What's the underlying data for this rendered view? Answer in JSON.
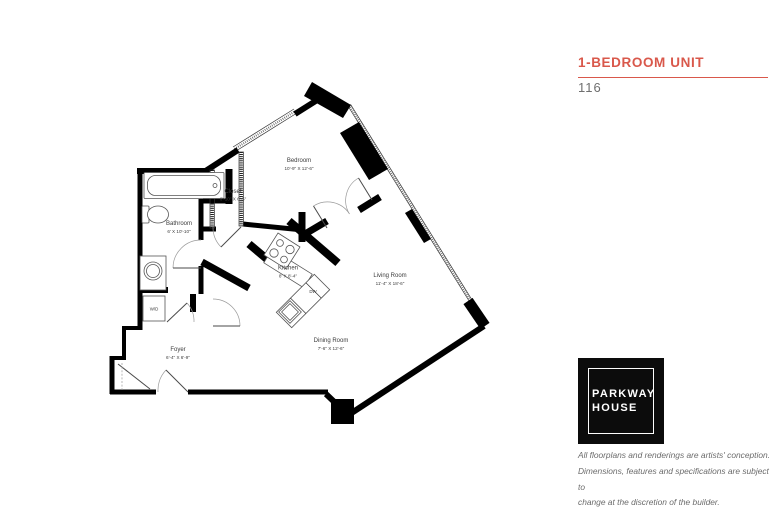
{
  "header": {
    "title": "1-BEDROOM UNIT",
    "unit_number": "116"
  },
  "branding": {
    "logo_line1": "PARKWAY",
    "logo_line2": "HOUSE"
  },
  "disclaimer": {
    "line1": "All floorplans and renderings are artists' conception.",
    "line2": "Dimensions, features and specifications are subject to",
    "line3": "change at the discretion of the builder."
  },
  "colors": {
    "accent": "#d9584b",
    "muted_text": "#6b6b6b",
    "wall": "#000000"
  },
  "floorplan": {
    "rooms": [
      {
        "name": "Bedroom",
        "dims": "10'-9\" X 12'-6\""
      },
      {
        "name": "Closet",
        "dims": "6'-10\" X 6'-5\""
      },
      {
        "name": "Bathroom",
        "dims": "6' X 10'-10\""
      },
      {
        "name": "Kitchen",
        "dims": "8' X 8'-4\""
      },
      {
        "name": "Living Room",
        "dims": "11'-4\" X 18'-6\""
      },
      {
        "name": "Dining Room",
        "dims": "7'-6\" X 12'-6\""
      },
      {
        "name": "Foyer",
        "dims": "6'-4\" X 6'-9\""
      }
    ],
    "appliances": {
      "washer_dryer": "W/D",
      "dishwasher": "DW"
    }
  }
}
